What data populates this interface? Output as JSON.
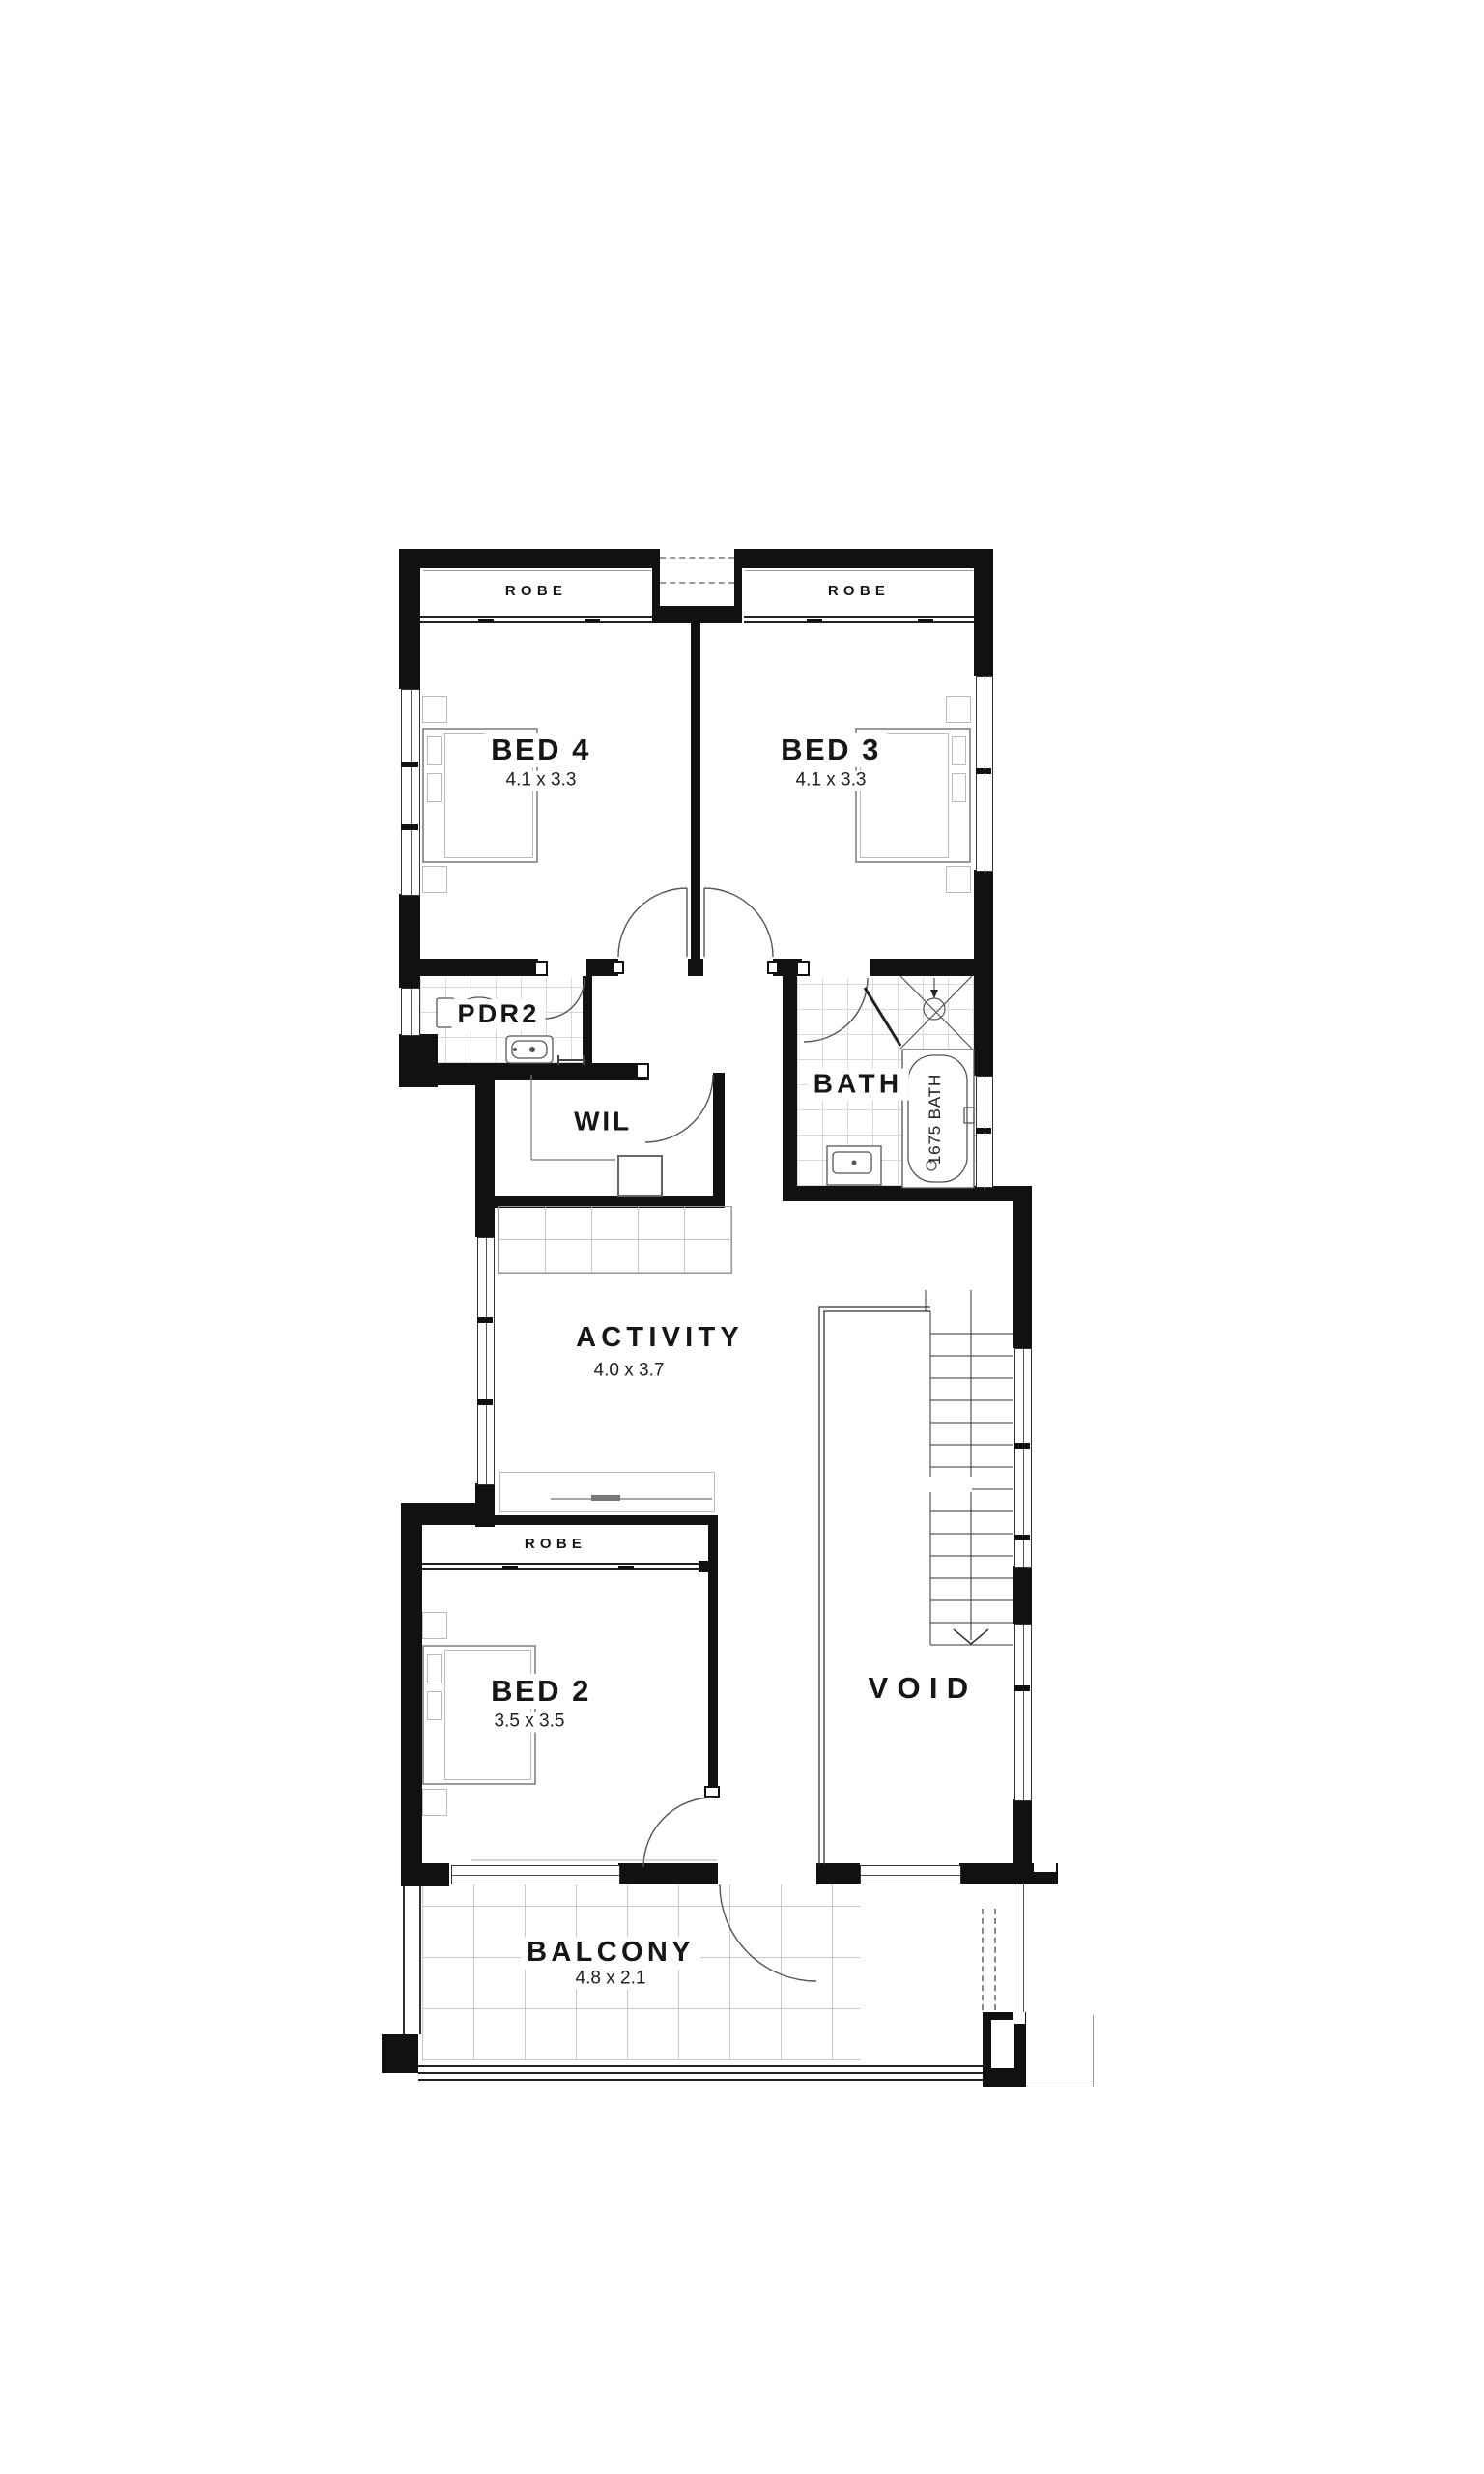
{
  "plan": {
    "title": "upper floor plan",
    "colors": {
      "wall": "#111111",
      "paper": "#ffffff"
    },
    "rooms": {
      "bed4": {
        "name": "BED 4",
        "dims": "4.1 x 3.3"
      },
      "bed3": {
        "name": "BED 3",
        "dims": "4.1 x 3.3"
      },
      "bed2": {
        "name": "BED 2",
        "dims": "3.5 x 3.5"
      },
      "activity": {
        "name": "ACTIVITY",
        "dims": "4.0 x 3.7"
      },
      "balcony": {
        "name": "BALCONY",
        "dims": "4.8 x 2.1"
      },
      "pdr2": {
        "name": "PDR2"
      },
      "wil": {
        "name": "WIL"
      },
      "bath": {
        "name": "BATH"
      },
      "void": {
        "name": "VOID"
      }
    },
    "labels": {
      "robe": "ROBE",
      "bath_tub": "1675 BATH"
    }
  }
}
